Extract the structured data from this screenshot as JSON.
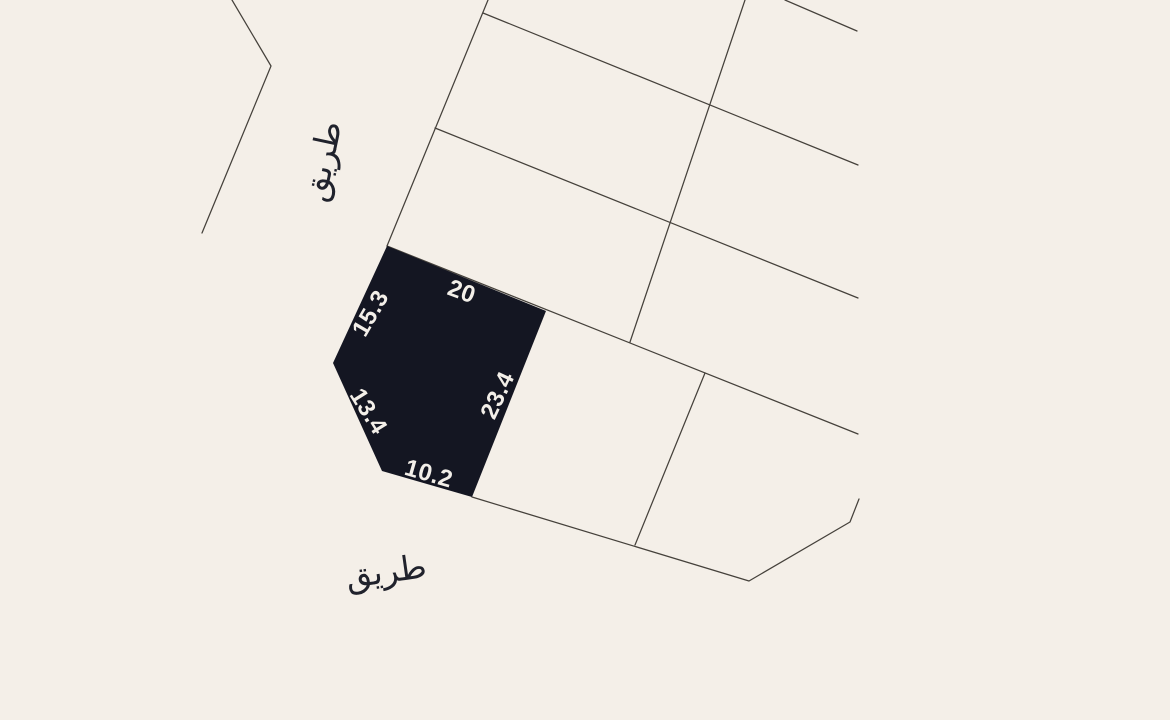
{
  "map": {
    "type": "cadastral-parcel-map",
    "background_color": "#f4efe8",
    "boundary_line_color": "#45413b",
    "selected_plot": {
      "fill_color": "#141622",
      "dimension_label_color": "#f3efe9",
      "dimensions": {
        "top": "20",
        "upper_left": "15.3",
        "lower_left": "13.4",
        "right": "23.4",
        "bottom": "10.2"
      }
    },
    "road_labels": {
      "color": "#20222c",
      "top": "طريق",
      "bottom": "طريق"
    }
  }
}
